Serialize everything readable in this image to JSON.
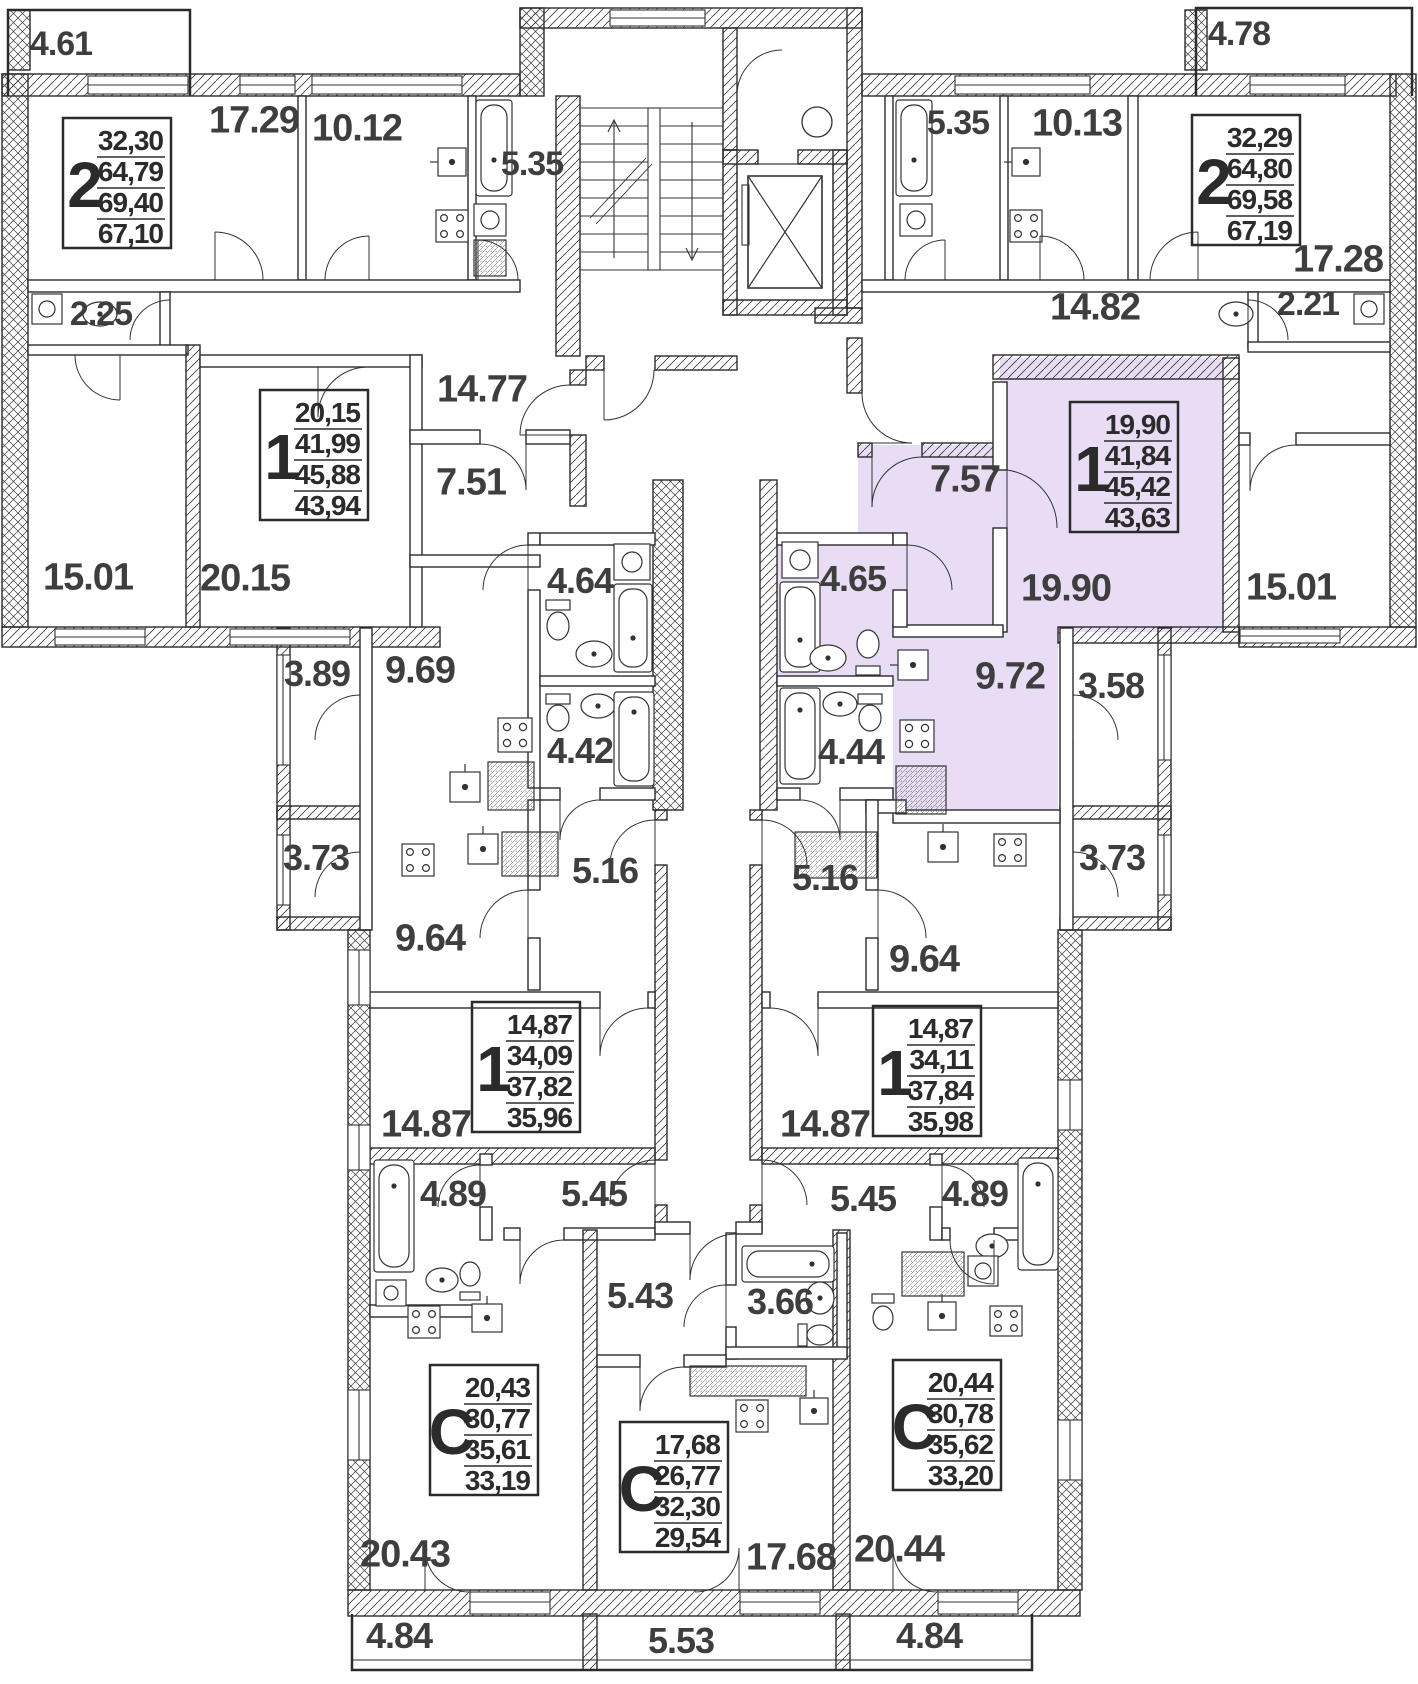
{
  "plan_title": "Residential floor plan",
  "highlight": {
    "color": "#e9ddf6",
    "selected_apartment_type": "1",
    "selected_rooms": [
      "7.57",
      "19.90",
      "4.65",
      "9.72"
    ]
  },
  "apartment_boxes": [
    {
      "id": "apt-2-top-left",
      "x": 63,
      "y": 118,
      "type": "2",
      "v1": "32,30",
      "v2": "64,79",
      "v3": "69,40",
      "v4": "67,10",
      "highlighted": false
    },
    {
      "id": "apt-2-top-right",
      "x": 1192,
      "y": 115,
      "type": "2",
      "v1": "32,29",
      "v2": "64,80",
      "v3": "69,58",
      "v4": "67,19",
      "highlighted": false
    },
    {
      "id": "apt-1-mid-left",
      "x": 260,
      "y": 390,
      "type": "1",
      "v1": "20,15",
      "v2": "41,99",
      "v3": "45,88",
      "v4": "43,94",
      "highlighted": false
    },
    {
      "id": "apt-1-mid-right",
      "x": 1070,
      "y": 402,
      "type": "1",
      "v1": "19,90",
      "v2": "41,84",
      "v3": "45,42",
      "v4": "43,63",
      "highlighted": true
    },
    {
      "id": "apt-1-lower-left",
      "x": 472,
      "y": 1002,
      "type": "1",
      "v1": "14,87",
      "v2": "34,09",
      "v3": "37,82",
      "v4": "35,96",
      "highlighted": false
    },
    {
      "id": "apt-1-lower-right",
      "x": 873,
      "y": 1006,
      "type": "1",
      "v1": "14,87",
      "v2": "34,11",
      "v3": "37,84",
      "v4": "35,98",
      "highlighted": false
    },
    {
      "id": "studio-left",
      "x": 430,
      "y": 1365,
      "type": "С",
      "v1": "20,43",
      "v2": "30,77",
      "v3": "35,61",
      "v4": "33,19",
      "highlighted": false
    },
    {
      "id": "studio-middle",
      "x": 620,
      "y": 1422,
      "type": "С",
      "v1": "17,68",
      "v2": "26,77",
      "v3": "32,30",
      "v4": "29,54",
      "highlighted": false
    },
    {
      "id": "studio-right",
      "x": 893,
      "y": 1360,
      "type": "С",
      "v1": "20,44",
      "v2": "30,78",
      "v3": "35,62",
      "v4": "33,20",
      "highlighted": false
    }
  ],
  "room_labels": [
    {
      "t": "4.61",
      "x": 61,
      "y": 43,
      "s": 34
    },
    {
      "t": "17.29",
      "x": 254,
      "y": 119,
      "s": 38
    },
    {
      "t": "10.12",
      "x": 357,
      "y": 127,
      "s": 38
    },
    {
      "t": "5.35",
      "x": 532,
      "y": 163,
      "s": 34
    },
    {
      "t": "5.35",
      "x": 958,
      "y": 122,
      "s": 34
    },
    {
      "t": "10.13",
      "x": 1077,
      "y": 122,
      "s": 38
    },
    {
      "t": "4.78",
      "x": 1239,
      "y": 33,
      "s": 34
    },
    {
      "t": "17.28",
      "x": 1338,
      "y": 258,
      "s": 38
    },
    {
      "t": "2.25",
      "x": 101,
      "y": 313,
      "s": 34
    },
    {
      "t": "14.82",
      "x": 1095,
      "y": 306,
      "s": 38
    },
    {
      "t": "2.21",
      "x": 1308,
      "y": 303,
      "s": 34
    },
    {
      "t": "14.77",
      "x": 482,
      "y": 388,
      "s": 38
    },
    {
      "t": "7.51",
      "x": 471,
      "y": 481,
      "s": 38
    },
    {
      "t": "7.57",
      "x": 965,
      "y": 478,
      "s": 38
    },
    {
      "t": "15.01",
      "x": 88,
      "y": 576,
      "s": 38
    },
    {
      "t": "20.15",
      "x": 245,
      "y": 577,
      "s": 38
    },
    {
      "t": "19.90",
      "x": 1066,
      "y": 587,
      "s": 38
    },
    {
      "t": "15.01",
      "x": 1291,
      "y": 586,
      "s": 38
    },
    {
      "t": "4.64",
      "x": 580,
      "y": 580,
      "s": 36
    },
    {
      "t": "4.65",
      "x": 853,
      "y": 578,
      "s": 36
    },
    {
      "t": "3.89",
      "x": 317,
      "y": 673,
      "s": 36
    },
    {
      "t": "9.69",
      "x": 420,
      "y": 669,
      "s": 38
    },
    {
      "t": "9.72",
      "x": 1010,
      "y": 675,
      "s": 38
    },
    {
      "t": "3.58",
      "x": 1111,
      "y": 685,
      "s": 36
    },
    {
      "t": "4.42",
      "x": 580,
      "y": 750,
      "s": 36
    },
    {
      "t": "4.44",
      "x": 851,
      "y": 751,
      "s": 36
    },
    {
      "t": "3.73",
      "x": 316,
      "y": 857,
      "s": 36
    },
    {
      "t": "5.16",
      "x": 605,
      "y": 870,
      "s": 36
    },
    {
      "t": "5.16",
      "x": 825,
      "y": 877,
      "s": 36
    },
    {
      "t": "3.73",
      "x": 1112,
      "y": 857,
      "s": 36
    },
    {
      "t": "9.64",
      "x": 430,
      "y": 937,
      "s": 38
    },
    {
      "t": "9.64",
      "x": 924,
      "y": 958,
      "s": 38
    },
    {
      "t": "14.87",
      "x": 426,
      "y": 1123,
      "s": 38
    },
    {
      "t": "14.87",
      "x": 825,
      "y": 1123,
      "s": 38
    },
    {
      "t": "4.89",
      "x": 453,
      "y": 1193,
      "s": 36
    },
    {
      "t": "5.45",
      "x": 594,
      "y": 1193,
      "s": 36
    },
    {
      "t": "5.45",
      "x": 863,
      "y": 1198,
      "s": 36
    },
    {
      "t": "4.89",
      "x": 975,
      "y": 1193,
      "s": 36
    },
    {
      "t": "5.43",
      "x": 640,
      "y": 1295,
      "s": 36
    },
    {
      "t": "3.66",
      "x": 780,
      "y": 1301,
      "s": 36
    },
    {
      "t": "20.43",
      "x": 405,
      "y": 1553,
      "s": 38
    },
    {
      "t": "17.68",
      "x": 791,
      "y": 1556,
      "s": 38
    },
    {
      "t": "20.44",
      "x": 899,
      "y": 1548,
      "s": 38
    },
    {
      "t": "4.84",
      "x": 399,
      "y": 1635,
      "s": 36
    },
    {
      "t": "5.53",
      "x": 681,
      "y": 1640,
      "s": 36
    },
    {
      "t": "4.84",
      "x": 929,
      "y": 1635,
      "s": 36
    }
  ]
}
